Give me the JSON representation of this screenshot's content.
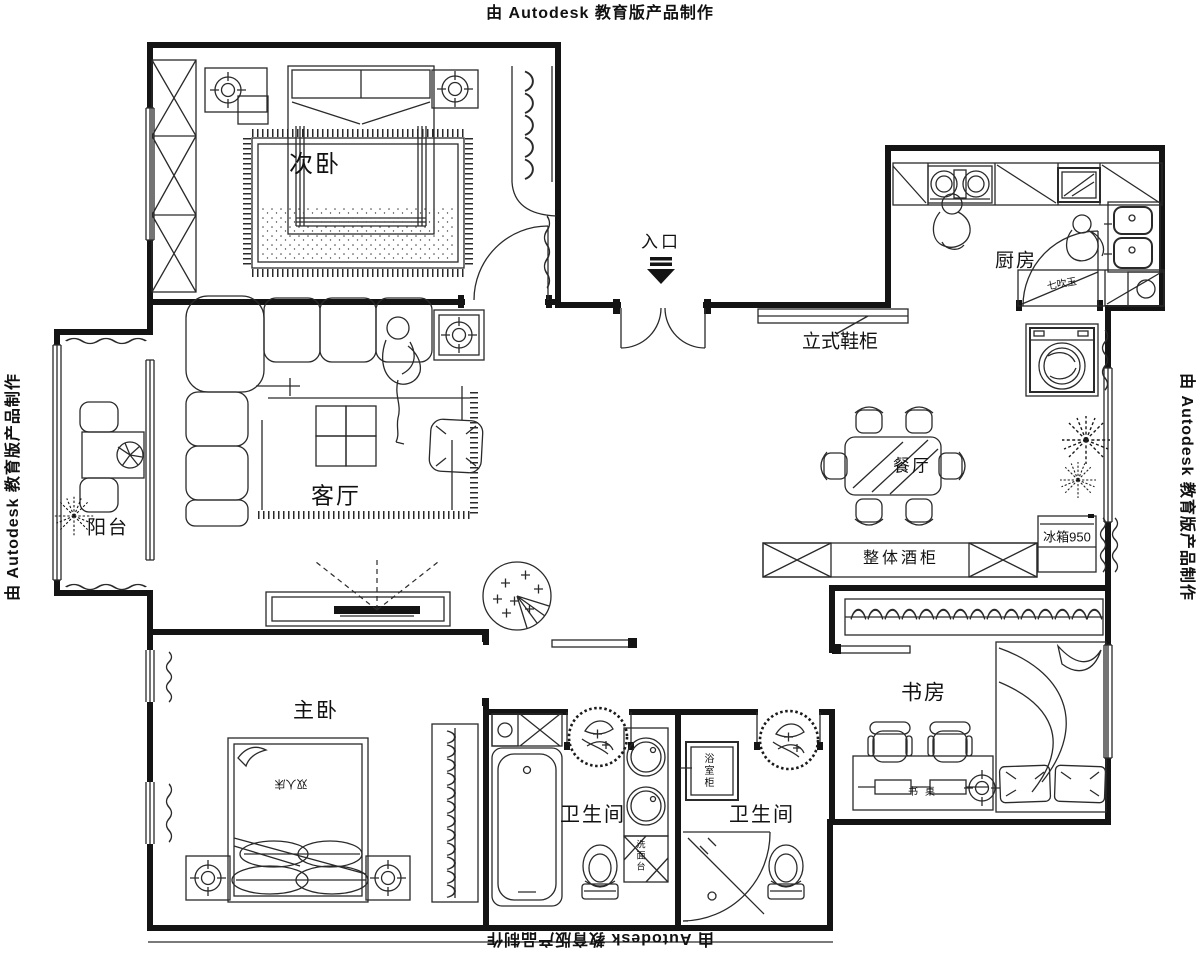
{
  "watermark": {
    "top": "由 Autodesk 教育版产品制作",
    "bottom": "由 Autodesk 教育版产品制作",
    "left": "由 Autodesk 教育版产品制作",
    "right": "由 Autodesk 教育版产品制作"
  },
  "rooms": {
    "secondary_bedroom": "次卧",
    "kitchen": "厨房",
    "living_room": "客厅",
    "balcony": "阳台",
    "dining_room": "餐厅",
    "study": "书房",
    "master_bedroom": "主卧",
    "bathroom_left": "卫生间",
    "bathroom_right": "卫生间"
  },
  "annotations": {
    "entrance": "入口",
    "shoe_cabinet": "立式鞋柜",
    "wine_cabinet": "整体酒柜",
    "fridge": "冰箱950",
    "double_bed": "双人床",
    "desk": "书桌",
    "bath_cabinet": "浴室柜",
    "basin_counter": "洗面台",
    "kitchen_cabinet": "七吹玉"
  },
  "colors": {
    "line": "#141414",
    "background": "#ffffff"
  }
}
